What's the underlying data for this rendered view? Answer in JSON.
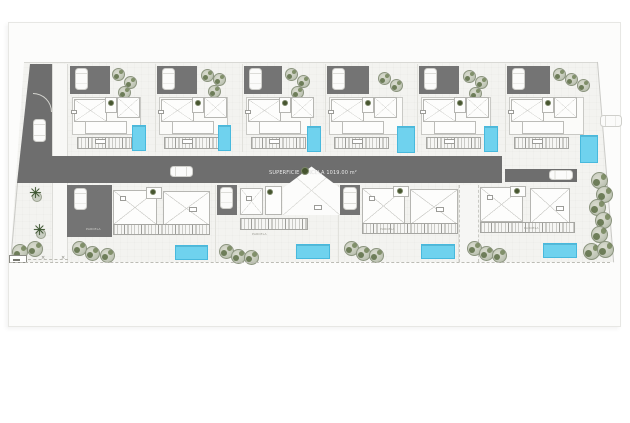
{
  "sheet": {
    "bg": "#fcfcfb",
    "border": "#e7e7e4"
  },
  "colors": {
    "road": "#6e6e6e",
    "driveway": "#747474",
    "paving": "#f3f3f0",
    "pool": "#6fd2ee",
    "pool_border": "#48b9dd",
    "tree_fill": "#c5cabb",
    "tree_dark": "#5d6f46",
    "palm": "#3d5531",
    "wall": "#b6b6b2",
    "label_text": "#f2f2f2"
  },
  "site": {
    "road_label": "SUPERFICIE PARCELA  1019.00 m²",
    "paving_polygon": [
      [
        16,
        2
      ],
      [
        589,
        2
      ],
      [
        605,
        202
      ],
      [
        2,
        202
      ]
    ],
    "left_road_polygon": [
      [
        15,
        0
      ],
      [
        37,
        0
      ],
      [
        37,
        119
      ],
      [
        2,
        119
      ]
    ],
    "main_road": {
      "x": 52,
      "y": 156,
      "w": 450,
      "h": 27
    },
    "side_lane": {
      "x": 505,
      "y": 169,
      "w": 72,
      "h": 13
    },
    "sidewalk": {
      "x": 52,
      "y": 64,
      "w": 16,
      "h": 198
    },
    "cars": [
      {
        "name": "car-left-road",
        "x": 33,
        "y": 119,
        "w": 13,
        "h": 23,
        "dir": "v"
      },
      {
        "name": "car-main-road",
        "x": 170,
        "y": 166,
        "w": 23,
        "h": 11,
        "dir": "h"
      },
      {
        "name": "car-side-lane",
        "x": 549,
        "y": 170,
        "w": 24,
        "h": 10,
        "dir": "h"
      },
      {
        "name": "car-outer-road",
        "x": 600,
        "y": 115,
        "w": 22,
        "h": 12,
        "dir": "h"
      }
    ],
    "road_tree_dot": {
      "x": 301,
      "y": 167,
      "s": 8
    }
  },
  "top_units": [
    {
      "id": "T1",
      "x": 68,
      "w": 87,
      "pool": {
        "x": 132,
        "y": 125,
        "w": 14,
        "h": 26
      },
      "trees": [
        [
          44,
          4
        ],
        [
          56,
          12
        ],
        [
          50,
          22
        ]
      ]
    },
    {
      "id": "T2",
      "x": 155,
      "w": 87,
      "pool": {
        "x": 218,
        "y": 125,
        "w": 13,
        "h": 26
      },
      "trees": [
        [
          46,
          5
        ],
        [
          58,
          9
        ],
        [
          53,
          21
        ]
      ]
    },
    {
      "id": "T3",
      "x": 242,
      "w": 83,
      "pool": {
        "x": 307,
        "y": 126,
        "w": 14,
        "h": 26
      },
      "trees": [
        [
          43,
          4
        ],
        [
          55,
          11
        ],
        [
          49,
          22
        ]
      ]
    },
    {
      "id": "T4",
      "x": 325,
      "w": 92,
      "pool": {
        "x": 397,
        "y": 126,
        "w": 18,
        "h": 27
      },
      "trees": [
        [
          53,
          8
        ],
        [
          65,
          15
        ]
      ]
    },
    {
      "id": "T5",
      "x": 417,
      "w": 88,
      "pool": {
        "x": 484,
        "y": 126,
        "w": 14,
        "h": 26
      },
      "trees": [
        [
          46,
          6
        ],
        [
          58,
          12
        ],
        [
          52,
          23
        ]
      ]
    },
    {
      "id": "T6",
      "x": 505,
      "w": 93,
      "pool": {
        "x": 580,
        "y": 135,
        "w": 18,
        "h": 28
      },
      "trees": [
        [
          48,
          4
        ],
        [
          60,
          9
        ],
        [
          72,
          15
        ]
      ]
    }
  ],
  "bottom_units": [
    {
      "id": "B1",
      "variant": "wide-drive",
      "label": "PARCELA",
      "drive": {
        "x": 67,
        "y": 185,
        "w": 45,
        "h": 52
      },
      "car": {
        "x": 74,
        "y": 188,
        "w": 13,
        "h": 22
      },
      "label_pos": {
        "x": 86,
        "y": 227
      },
      "x1": {
        "x": 113,
        "y": 190,
        "w": 44,
        "h": 35
      },
      "plant": {
        "x": 146,
        "y": 187,
        "w": 16,
        "h": 12
      },
      "x2": {
        "x": 163,
        "y": 191,
        "w": 47,
        "h": 35
      },
      "chip1": {
        "x": 120,
        "y": 196
      },
      "chip2": {
        "x": 189,
        "y": 207
      },
      "hatch": {
        "x": 113,
        "y": 224,
        "w": 97,
        "h": 11
      },
      "pool": {
        "x": 175,
        "y": 245,
        "w": 33,
        "h": 15
      },
      "trees": [
        [
          72,
          241
        ],
        [
          85,
          246
        ],
        [
          100,
          248
        ]
      ]
    },
    {
      "id": "B2",
      "variant": "hip-roof",
      "label": "PARCELA",
      "drive": {
        "x": 217,
        "y": 185,
        "w": 20,
        "h": 30
      },
      "car": {
        "x": 220,
        "y": 187,
        "w": 13,
        "h": 22
      },
      "label_pos": {
        "x": 252,
        "y": 232
      },
      "roomA": {
        "x": 240,
        "y": 188,
        "w": 23,
        "h": 27
      },
      "roomB": {
        "x": 265,
        "y": 186,
        "w": 17,
        "h": 29
      },
      "plant_dot": {
        "x": 267,
        "y": 189
      },
      "hip": {
        "x": 282,
        "y": 165,
        "w": 59,
        "h": 51
      },
      "chip1": {
        "x": 246,
        "y": 196
      },
      "chip2": {
        "x": 314,
        "y": 205
      },
      "hatch": {
        "x": 240,
        "y": 218,
        "w": 68,
        "h": 12
      },
      "pool": {
        "x": 296,
        "y": 244,
        "w": 34,
        "h": 15
      },
      "trees": [
        [
          219,
          244
        ],
        [
          231,
          249
        ],
        [
          244,
          250
        ]
      ]
    },
    {
      "id": "B3",
      "variant": "garage",
      "label": "PARCELA",
      "drive": {
        "x": 340,
        "y": 185,
        "w": 20,
        "h": 30
      },
      "car": {
        "x": 343,
        "y": 187,
        "w": 14,
        "h": 23
      },
      "label_pos": {
        "x": 380,
        "y": 227
      },
      "x1": {
        "x": 362,
        "y": 188,
        "w": 43,
        "h": 36
      },
      "plant": {
        "x": 393,
        "y": 186,
        "w": 16,
        "h": 11
      },
      "x2": {
        "x": 410,
        "y": 189,
        "w": 48,
        "h": 36
      },
      "chip1": {
        "x": 369,
        "y": 196
      },
      "chip2": {
        "x": 436,
        "y": 207
      },
      "hatch": {
        "x": 362,
        "y": 223,
        "w": 96,
        "h": 11
      },
      "pool": {
        "x": 421,
        "y": 244,
        "w": 34,
        "h": 15
      },
      "trees": [
        [
          344,
          241
        ],
        [
          356,
          246
        ],
        [
          369,
          248
        ]
      ]
    },
    {
      "id": "B4",
      "variant": "lane",
      "label": "PARCELA",
      "lane": {
        "x": 459,
        "y": 185,
        "w": 20,
        "h": 77
      },
      "label_pos": {
        "x": 524,
        "y": 226
      },
      "x1": {
        "x": 480,
        "y": 187,
        "w": 43,
        "h": 35
      },
      "plant": {
        "x": 510,
        "y": 186,
        "w": 16,
        "h": 11
      },
      "x2": {
        "x": 530,
        "y": 188,
        "w": 40,
        "h": 36
      },
      "chip1": {
        "x": 487,
        "y": 195
      },
      "chip2": {
        "x": 556,
        "y": 206
      },
      "hatch": {
        "x": 480,
        "y": 222,
        "w": 95,
        "h": 11
      },
      "pool": {
        "x": 543,
        "y": 243,
        "w": 34,
        "h": 15
      },
      "trees": [
        [
          467,
          241
        ],
        [
          479,
          246
        ],
        [
          492,
          248
        ]
      ]
    }
  ],
  "environment": {
    "palms": [
      [
        29,
        186
      ],
      [
        33,
        223
      ]
    ],
    "left_trees": [
      [
        12,
        244
      ],
      [
        27,
        241
      ]
    ],
    "right_trees": [
      [
        591,
        172
      ],
      [
        596,
        186
      ],
      [
        589,
        199
      ],
      [
        595,
        212
      ],
      [
        591,
        226
      ],
      [
        583,
        243
      ],
      [
        597,
        241
      ]
    ],
    "markers": [
      [
        41,
        256
      ],
      [
        61,
        256
      ]
    ]
  }
}
